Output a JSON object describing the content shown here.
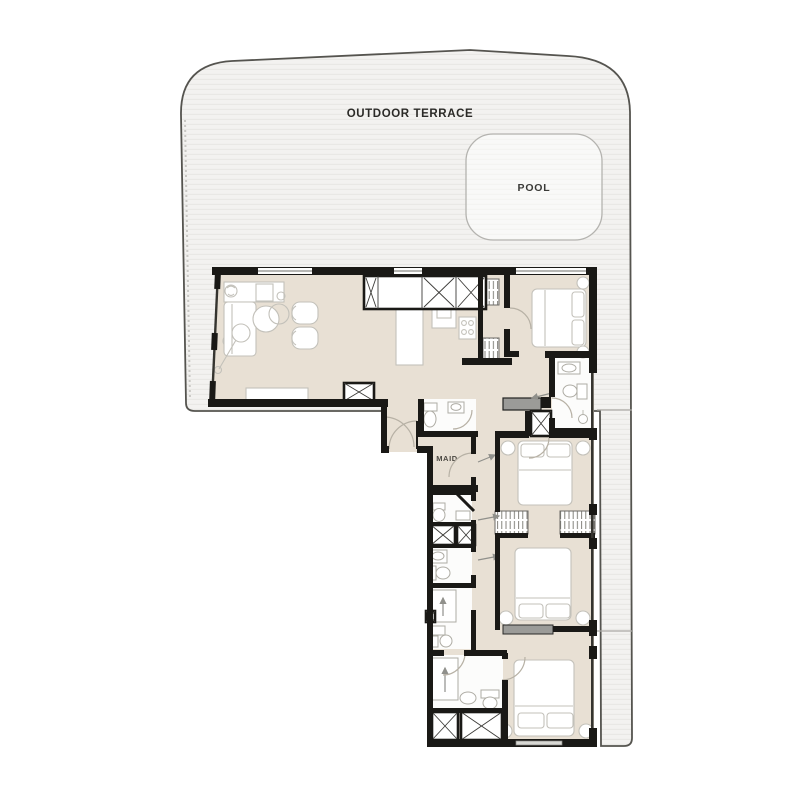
{
  "labels": {
    "outdoor_terrace": "OUTDOOR TERRACE",
    "pool": "POOL",
    "maid": "MAID"
  },
  "colors": {
    "wall": "#1a1916",
    "apartment_floor": "#e8e0d4",
    "terrace_fill": "#f3f2f0",
    "terrace_stripe": "#e9e8e5",
    "terrace_outline": "#55544f",
    "pool_outline": "#b4b3af",
    "furniture_outline": "#c3c1ba",
    "door_arc": "#b7b1a5",
    "gray_fixture": "#9b9b98",
    "label_text": "#2b2a27"
  }
}
